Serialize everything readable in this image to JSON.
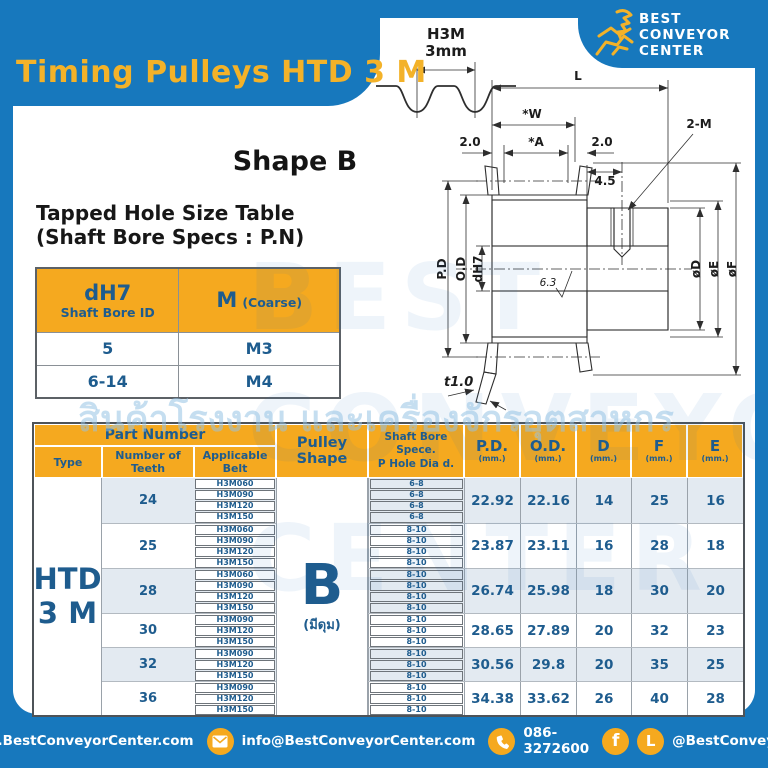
{
  "colors": {
    "blue": "#1778BD",
    "orange": "#F5A91F",
    "text_blue": "#1E5C8E",
    "band": "#E3EAF1",
    "title_yellow": "#F3B229"
  },
  "page": {
    "title": "Timing Pulleys HTD 3 M"
  },
  "brand": {
    "line1": "BEST",
    "line2": "CONVEYOR",
    "line3": "CENTER"
  },
  "profile": {
    "name": "H3M",
    "pitch": "3mm"
  },
  "shape_heading": "Shape B",
  "tapped": {
    "heading1": "Tapped Hole Size Table",
    "heading2": "(Shaft Bore Specs : P.N)",
    "col1_main": "dH7",
    "col1_sub": "Shaft Bore ID",
    "col2_main": "M",
    "col2_sub": "(Coarse)",
    "rows": [
      [
        "5",
        "M3"
      ],
      [
        "6-14",
        "M4"
      ]
    ]
  },
  "drawing": {
    "L": "L",
    "W": "*W",
    "A": "*A",
    "m_left": "2.0",
    "m_right": "2.0",
    "offset": "4.5",
    "tap": "2-M",
    "pd": "P.D",
    "od": "O.D",
    "bore": "dH7",
    "rough": "6.3",
    "dia_d": "øD",
    "dia_e": "øE",
    "dia_f": "øF",
    "t": "t1.0"
  },
  "table": {
    "headers": {
      "part_number": "Part Number",
      "type": "Type",
      "teeth": "Number of Teeth",
      "belt": "Applicable Belt",
      "shape": "Pulley Shape",
      "bore1": "Shaft Bore Spece.",
      "bore2": "P Hole Dia d.",
      "pd": "P.D.",
      "od": "O.D.",
      "d": "D",
      "f": "F",
      "e": "E",
      "unit": "(mm.)"
    },
    "type_l1": "HTD",
    "type_l2": "3 M",
    "shape_main": "B",
    "shape_sub": "(มีดุม)",
    "groups": [
      {
        "teeth": "24",
        "belts": [
          "H3M060",
          "H3M090",
          "H3M120",
          "H3M150"
        ],
        "bores": [
          "6-8",
          "6-8",
          "6-8",
          "6-8"
        ],
        "pd": "22.92",
        "od": "22.16",
        "d": "14",
        "f": "25",
        "e": "16"
      },
      {
        "teeth": "25",
        "belts": [
          "H3M060",
          "H3M090",
          "H3M120",
          "H3M150"
        ],
        "bores": [
          "8-10",
          "8-10",
          "8-10",
          "8-10"
        ],
        "pd": "23.87",
        "od": "23.11",
        "d": "16",
        "f": "28",
        "e": "18"
      },
      {
        "teeth": "28",
        "belts": [
          "H3M060",
          "H3M090",
          "H3M120",
          "H3M150"
        ],
        "bores": [
          "8-10",
          "8-10",
          "8-10",
          "8-10"
        ],
        "pd": "26.74",
        "od": "25.98",
        "d": "18",
        "f": "30",
        "e": "20"
      },
      {
        "teeth": "30",
        "belts": [
          "H3M090",
          "H3M120",
          "H3M150"
        ],
        "bores": [
          "8-10",
          "8-10",
          "8-10"
        ],
        "pd": "28.65",
        "od": "27.89",
        "d": "20",
        "f": "32",
        "e": "23"
      },
      {
        "teeth": "32",
        "belts": [
          "H3M090",
          "H3M120",
          "H3M150"
        ],
        "bores": [
          "8-10",
          "8-10",
          "8-10"
        ],
        "pd": "30.56",
        "od": "29.8",
        "d": "20",
        "f": "35",
        "e": "25"
      },
      {
        "teeth": "36",
        "belts": [
          "H3M090",
          "H3M120",
          "H3M150"
        ],
        "bores": [
          "8-10",
          "8-10",
          "8-10"
        ],
        "pd": "34.38",
        "od": "33.62",
        "d": "26",
        "f": "40",
        "e": "28"
      }
    ]
  },
  "footer": {
    "website": "www.BestConveyorCenter.com",
    "email": "info@BestConveyorCenter.com",
    "phone": "086-3272600",
    "social": "@BestConveyorCenter"
  },
  "watermark": {
    "en1": "BEST",
    "en2": "CONVEYOR",
    "en3": "CENTER",
    "thai": "สินค้าโรงงาน และเครื่องจักรอุตสาหกร"
  }
}
